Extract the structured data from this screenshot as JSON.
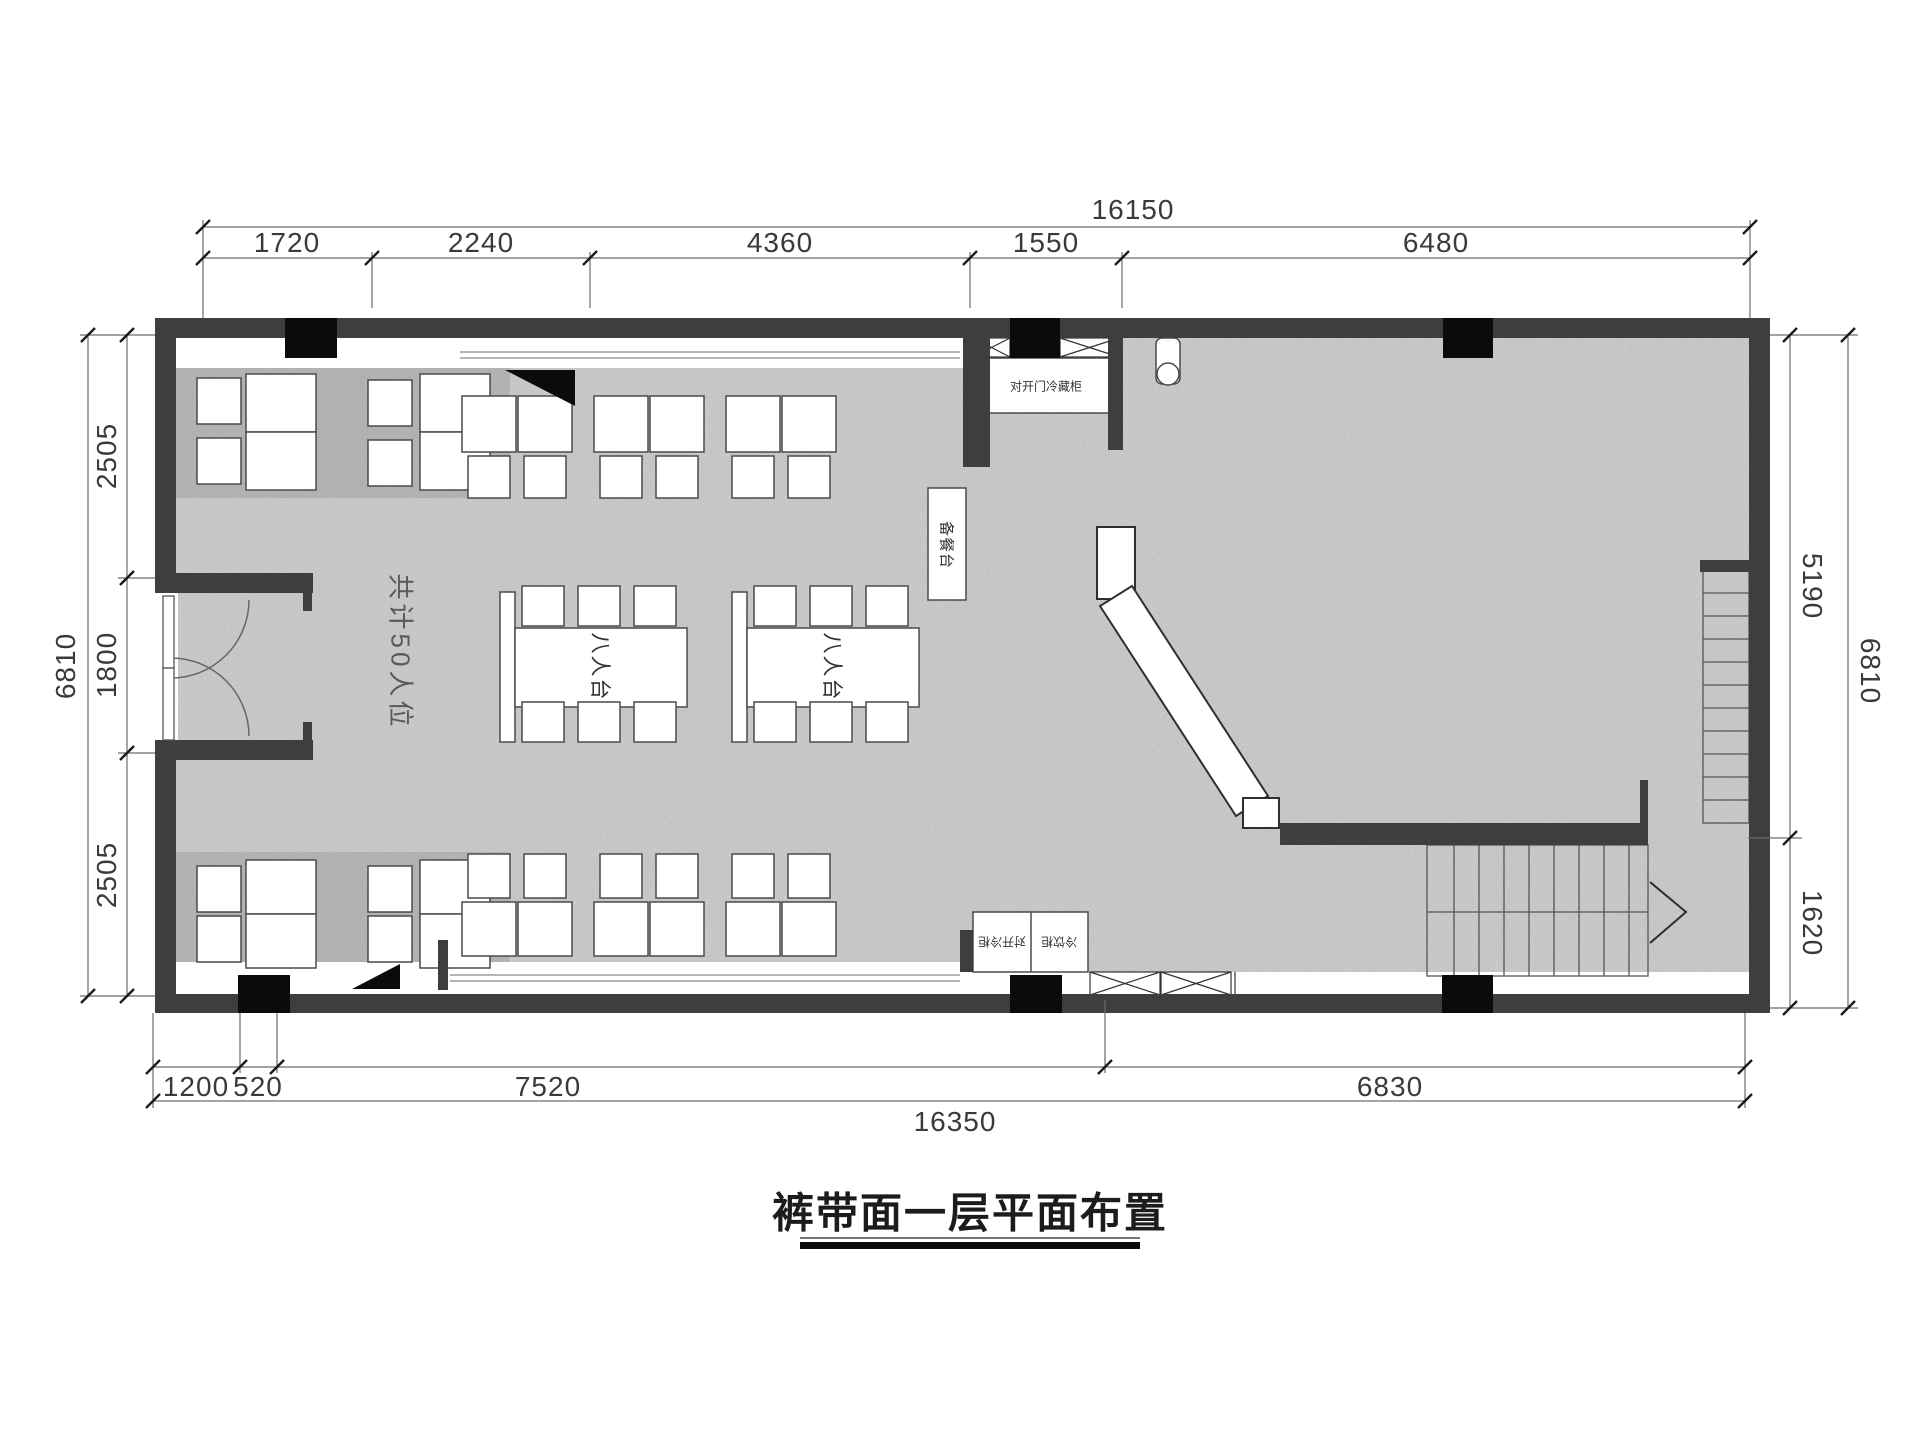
{
  "title": {
    "text": "裤带面一层平面布置"
  },
  "plan_labels": {
    "seat_count": "共计50人位",
    "table_1": "八人台",
    "table_2": "八人台",
    "service_counter": "备餐台",
    "fridge_cabinet": "对开门冷藏柜",
    "cabinet_left": "对开冷柜",
    "cabinet_right": "冷饮柜"
  },
  "dimensions": {
    "top": {
      "overall": "16150",
      "segments": [
        "1720",
        "2240",
        "4360",
        "1550",
        "6480"
      ]
    },
    "bottom": {
      "overall": "16350",
      "segments": [
        "1200",
        "520",
        "7520",
        "6830"
      ]
    },
    "left": {
      "overall": "6810",
      "segments": [
        "2505",
        "1800",
        "2505"
      ]
    },
    "right": {
      "overall": "6810",
      "segments": [
        "5190",
        "1620"
      ]
    }
  },
  "colors": {
    "wall": "#3e3e3e",
    "column": "#0b0b0b",
    "floor": "#9e9e9e",
    "rug": "#c4c4c4",
    "furniture_fill": "#ffffff",
    "line": "#555555",
    "dim_text": "#3a3a3a"
  }
}
